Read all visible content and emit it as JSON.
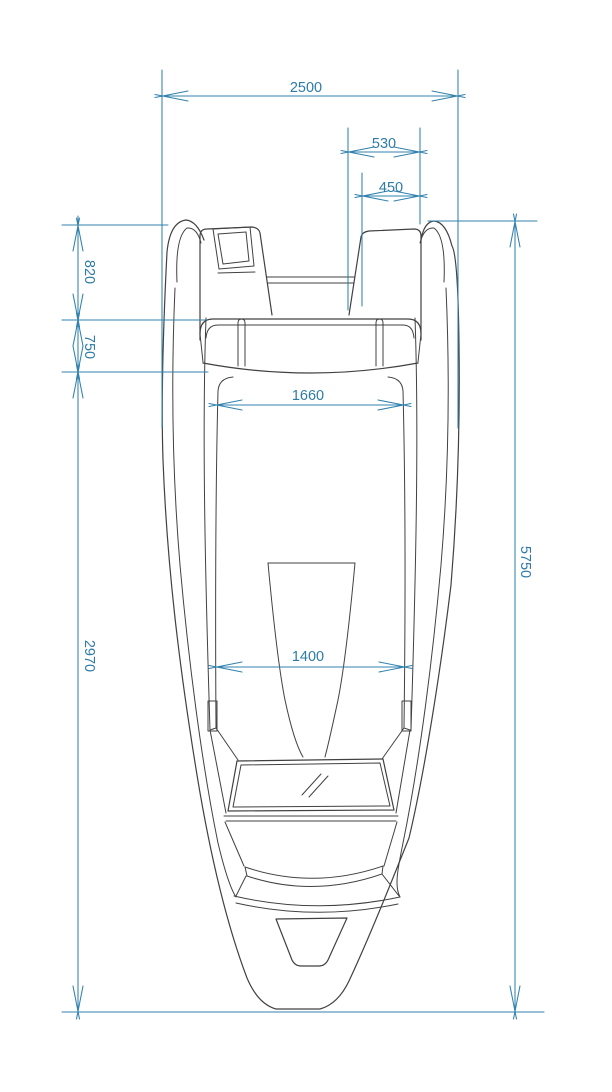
{
  "drawing": {
    "type": "technical-top-view",
    "dimensions": {
      "beam_overall": "2500",
      "stern_well_outer_width": "530",
      "stern_well_inner_width": "450",
      "stern_section_length": "820",
      "seat_section_length": "750",
      "cockpit_width_aft": "1660",
      "forward_section_length": "2970",
      "cockpit_width_forward": "1400",
      "length_overall": "5750"
    },
    "colors": {
      "dimension_blue": "#3182ad",
      "dimension_text_blue": "#2e7ba8",
      "outline_gray": "#414141",
      "background": "#ffffff"
    }
  }
}
